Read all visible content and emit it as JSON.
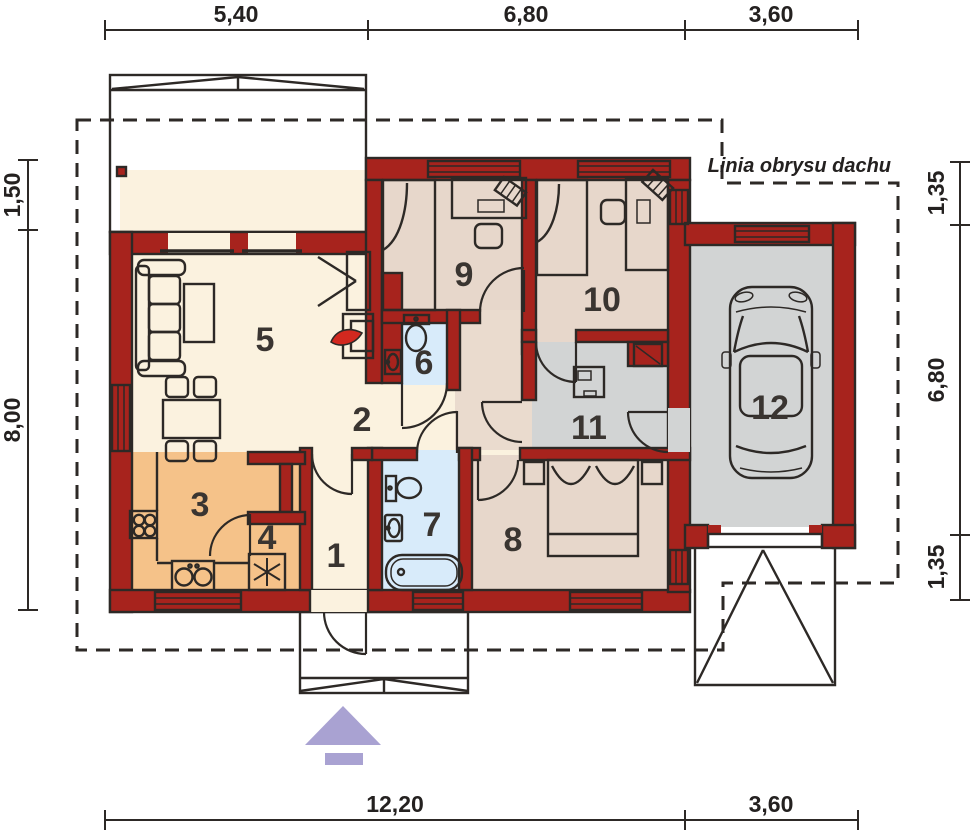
{
  "plan": {
    "roof_label": "Linia obrysu dachu",
    "room_numbers": [
      "1",
      "2",
      "3",
      "4",
      "5",
      "6",
      "7",
      "8",
      "9",
      "10",
      "11",
      "12"
    ],
    "dimensions": {
      "top": [
        "5,40",
        "6,80",
        "3,60"
      ],
      "bottom": [
        "12,20",
        "3,60"
      ],
      "left": [
        "1,50",
        "8,00"
      ],
      "right": [
        "1,35",
        "6,80",
        "1,35"
      ]
    },
    "colors": {
      "wall": "#a7231d",
      "line": "#2d2926",
      "cream": "#fbf2df",
      "kitchen": "#f5c289",
      "bedroom": "#e7d7cb",
      "corridor": "#eadbce",
      "bath": "#d8ebfa",
      "garage": "#d2d4d4",
      "window": "#e9e5dc",
      "fireplace": "#f7e431",
      "flame": "#d2281f",
      "arrow": "#a9a2d2"
    }
  }
}
